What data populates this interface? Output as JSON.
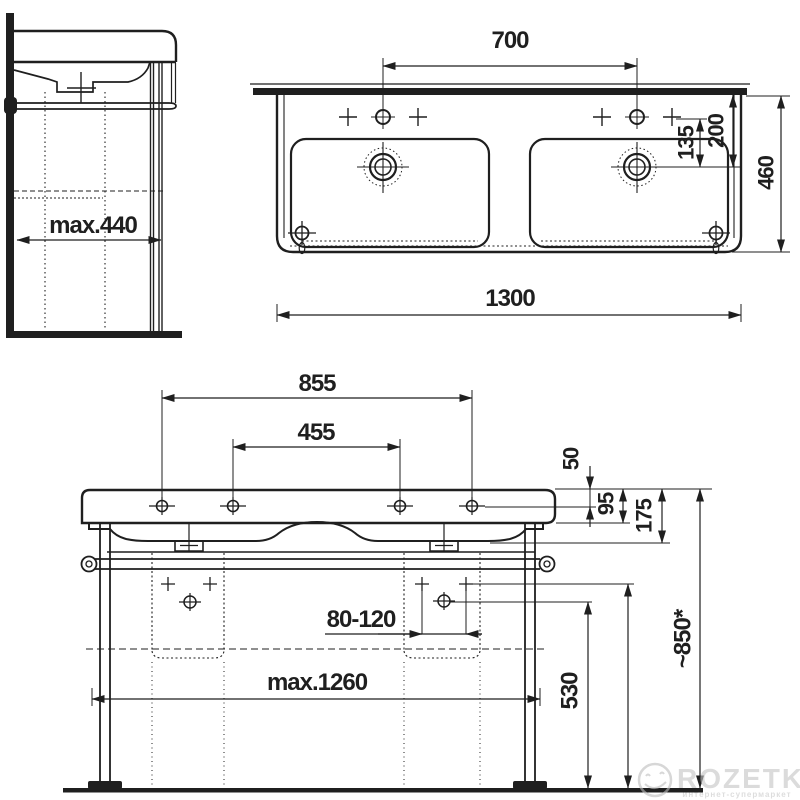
{
  "colors": {
    "ink": "#1f1f1f",
    "watermark_gray": "#c4c4c4"
  },
  "side_view": {
    "max_depth": "max.440"
  },
  "top_view": {
    "faucet_spacing": "700",
    "hole_to_drain_offset": "135",
    "edge_to_drain_offset": "200",
    "depth": "460",
    "width": "1300"
  },
  "front_view": {
    "outer_hole_spacing": "855",
    "inner_hole_spacing": "455",
    "top_to_hole": "50",
    "rim_height": "95",
    "body_height": "175",
    "drain_outlet_range": "80-120",
    "max_leg_spacing": "max.1260",
    "trap_line_height": "530",
    "outlet_line_height": "580",
    "mounting_height": "~850*"
  },
  "watermark": {
    "brand": "ROZETKA",
    "tagline": "интернет-супермаркет"
  }
}
